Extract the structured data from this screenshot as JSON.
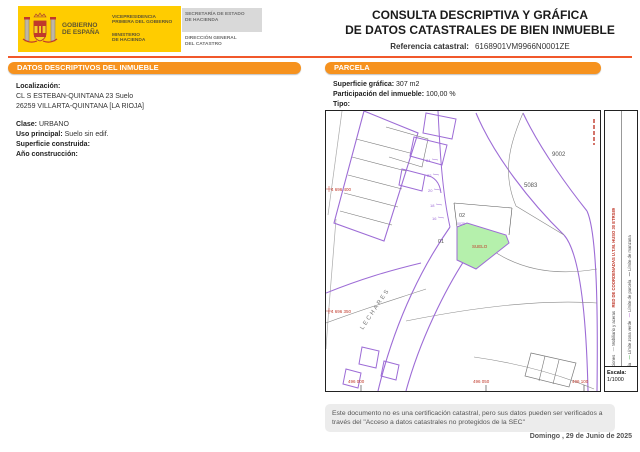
{
  "header": {
    "logo": {
      "gobierno_l1": "GOBIERNO",
      "gobierno_l2": "DE ESPAÑA",
      "vicepresidencia_l1": "VICEPRESIDENCIA",
      "vicepresidencia_l2": "PRIMERA DEL GOBIERNO",
      "ministerio_l1": "MINISTERIO",
      "ministerio_l2": "DE HACIENDA",
      "secretaria_l1": "SECRETARÍA DE ESTADO",
      "secretaria_l2": "DE HACIENDA",
      "direccion_l1": "DIRECCIÓN GENERAL",
      "direccion_l2": "DEL CATASTRO"
    },
    "title_line1": "CONSULTA DESCRIPTIVA Y GRÁFICA",
    "title_line2": "DE DATOS CATASTRALES DE BIEN INMUEBLE",
    "ref_label": "Referencia catastral:",
    "ref_value": "6168901VM9966N0001ZE"
  },
  "descriptivos": {
    "title": "DATOS DESCRIPTIVOS DEL INMUEBLE",
    "localizacion_label": "Localización:",
    "localizacion_line1": "CL S ESTEBAN-QUINTANA 23 Suelo",
    "localizacion_line2": "26259 VILLARTA-QUINTANA [LA RIOJA]",
    "clase_label": "Clase:",
    "clase_value": "URBANO",
    "uso_label": "Uso principal:",
    "uso_value": "Suelo sin edif.",
    "superficie_label": "Superficie construida:",
    "superficie_value": "",
    "anio_label": "Año construcción:",
    "anio_value": ""
  },
  "parcela": {
    "title": "PARCELA",
    "superficie_label": "Superficie gráfica:",
    "superficie_value": "307 m2",
    "participacion_label": "Participación del inmueble:",
    "participacion_value": "100,00 %",
    "tipo_label": "Tipo:",
    "tipo_value": ""
  },
  "map": {
    "labels": {
      "manzana_9002": "9002",
      "parcela_5083": "5083",
      "subparcela_02": "02",
      "subparcela_01": "01",
      "suelo": "SUELO",
      "codigo": "0025",
      "street": "LECHARES"
    },
    "street_numbers": [
      "24",
      "22",
      "20",
      "18",
      "16"
    ],
    "coords": {
      "y_top": "4 696 400",
      "y_bottom": "4 696 350",
      "x_left": "496 000",
      "x_mid": "496 050",
      "x_right": "496 100"
    },
    "legend_col1": [
      {
        "color": "#555555",
        "label": "Construcciones"
      },
      {
        "color": "#999999",
        "label": "Mobiliario y aceras"
      }
    ],
    "legend_col2": [
      {
        "color": "#3b7fd4",
        "label": "Hidrografía"
      },
      {
        "color": "#4caf50",
        "label": "Límite zona verde"
      },
      {
        "color": "#b56ad0",
        "label": "Límite de parcela"
      },
      {
        "color": "#444444",
        "label": "Límite de manzana"
      }
    ],
    "utm_note": "RED DE COORDENADAS U.T.M. HUSO 30 ETRS89",
    "escala_label": "Escala:",
    "escala_value": "1/1000"
  },
  "footer": {
    "note_line1": "Este documento no es una certificación catastral, pero sus datos pueden ser verificados a",
    "note_line2": "través del \"Acceso a datos catastrales no protegidos de la SEC\"",
    "date": "Domingo , 29 de Junio de 2025"
  },
  "colors": {
    "accent_orange": "#f6921e",
    "rule_orange": "#f1582b",
    "logo_yellow": "#ffcc00",
    "parcel_purple": "#9d6cd6",
    "subject_green": "#b5f0ac",
    "coord_red": "#c0392b"
  }
}
